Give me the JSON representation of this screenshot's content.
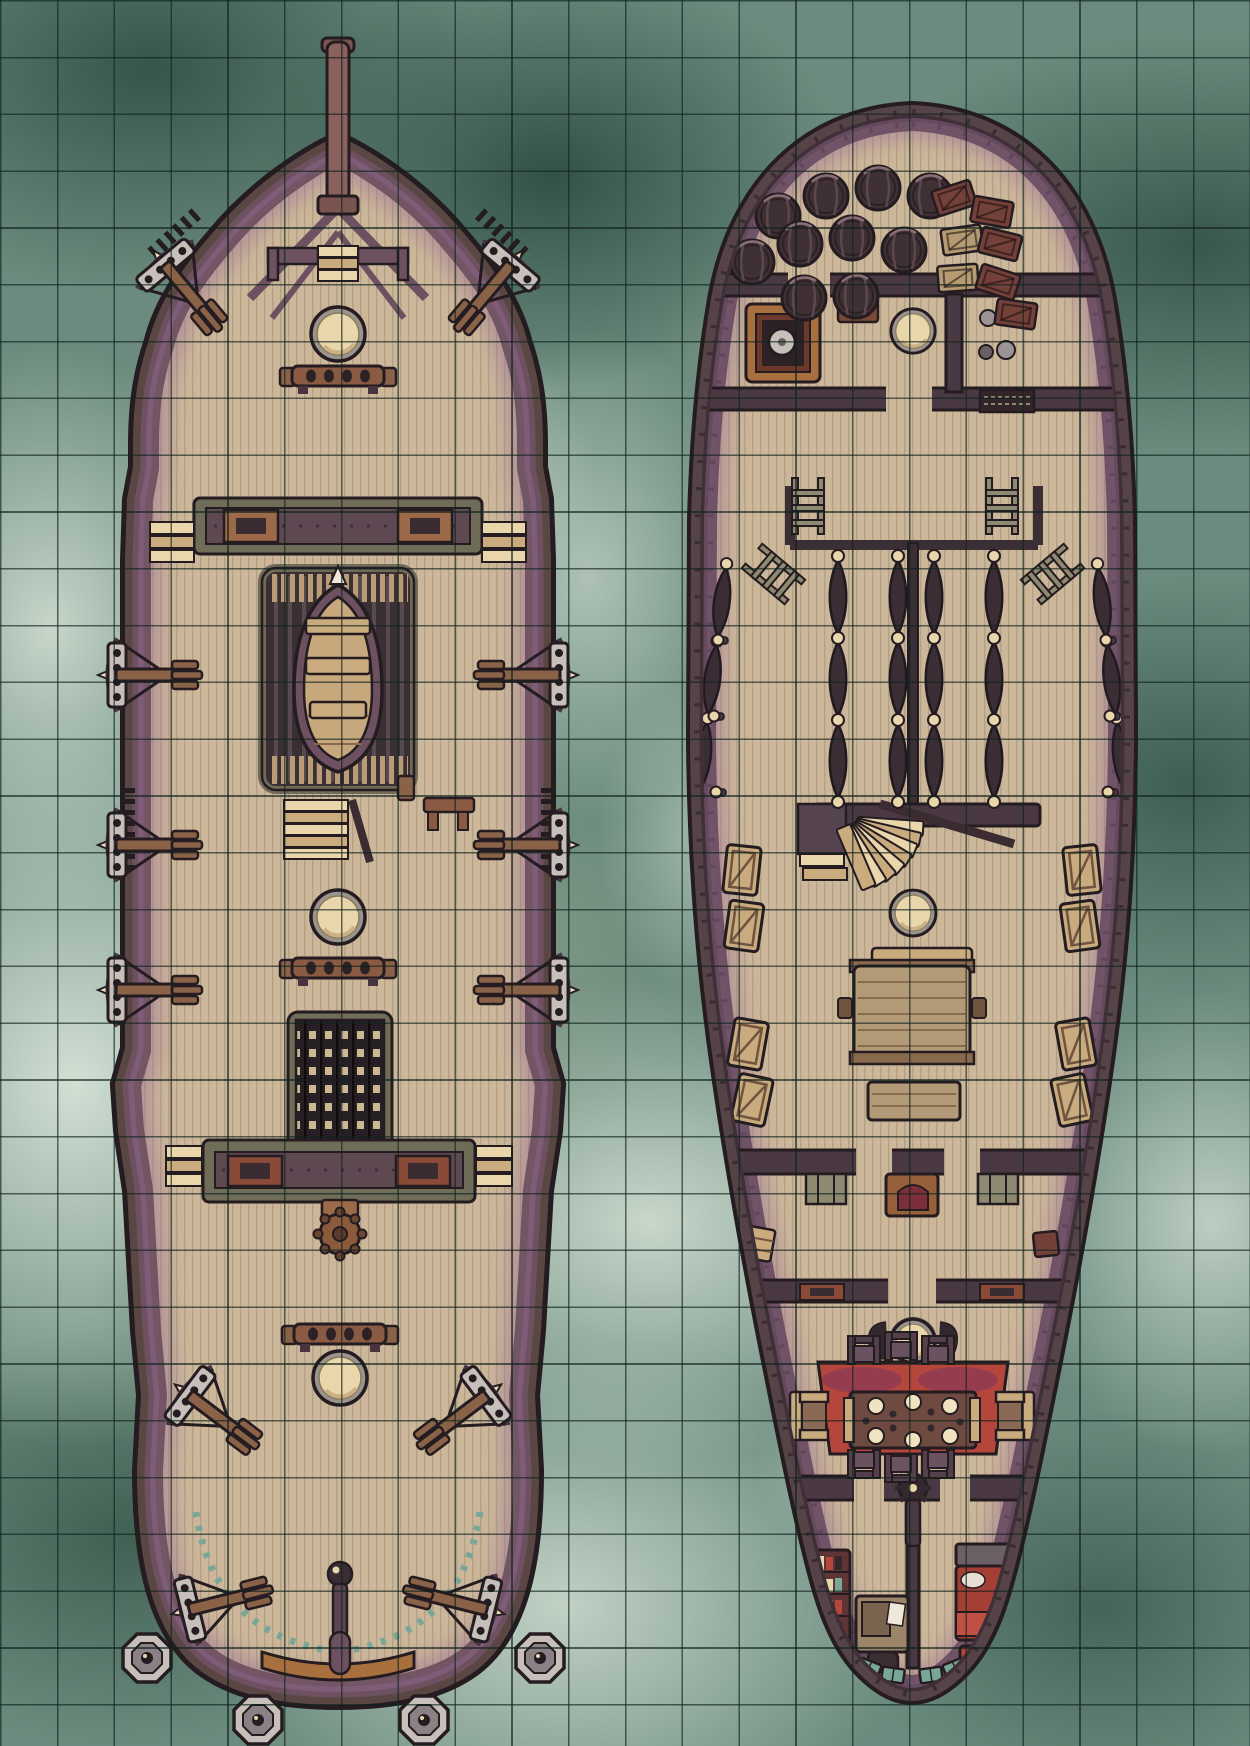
{
  "map": {
    "title": "Sailing ship battle map",
    "kind": "top-down tabletop battle map",
    "environment": "stormy green sea with white foam",
    "decks": [
      "weather deck (left ship view)",
      "lower deck interior (right ship view)"
    ]
  },
  "grid": {
    "cell_px": 56.8,
    "columns": 22,
    "rows": 31,
    "line_color": "rgba(16,34,29,0.65)"
  },
  "palette": {
    "sea-base": "#6a8b7d",
    "sea-dark": "#2e5449",
    "sea-foam": "#e6ede5",
    "sea-khaki": "#8e9a7f",
    "grid-line": "rgba(16,34,29,0.65)",
    "ink": "#241c20",
    "hull": "#5a4743",
    "hull2": "#564347",
    "deck": "#ccb79a",
    "deck-line": "#b5a084",
    "rail": "#6d5160",
    "rail-dark": "#473440",
    "olive": "#6f6c58",
    "olive-light": "#8e8a72",
    "wood-mid": "#8a6248",
    "wood-light": "#c9ab7e",
    "cream": "#ead6ab",
    "cream-bright": "#f2e3c0",
    "metal": "#c6bfba",
    "dark": "#32282e",
    "red": "#b5463c",
    "red-deep": "#8e3630",
    "orange": "#a9703f",
    "teal": "#79a797",
    "purple-shade": "rgba(148,104,146,0.45)"
  },
  "ships": [
    {
      "id": "weather-deck-ship",
      "label": "Weather deck (exterior top view)",
      "objects": [
        "bowsprit",
        "bow platform with stairs",
        "foremast",
        "mainmast",
        "mizzenmast",
        "belaying pin racks (3)",
        "harpoon ballistas (12)",
        "ship's boat on skid platform",
        "companionway stairs with bench",
        "cargo hatch grate",
        "forecastle bulkhead with brackets",
        "quarterdeck bulkhead with side steps",
        "ship's wheel",
        "tiller and rudder post",
        "stern lanterns (4)"
      ]
    },
    {
      "id": "lower-deck-ship",
      "label": "Lower deck (interior cutaway)",
      "objects": [
        "cargo barrels (10)",
        "supply crates (7)",
        "galley stove with kettle",
        "wall sconce",
        "round galley table",
        "pantry jugs",
        "companionway landing with ladders (4)",
        "crew hammock rows (6)",
        "fan staircase",
        "mess table with benches",
        "ammunition crates (8)",
        "wall shelves",
        "arched cabinet",
        "carved door panels",
        "captain's dining table",
        "dining chairs (6)",
        "armchairs (2)",
        "red carpet",
        "rudder gear",
        "bookshelf",
        "writing desk with chair",
        "captain's bed",
        "sea chest",
        "stern gallery windows (8)"
      ]
    }
  ],
  "placements": [
    {
      "target": "wd-ballistas",
      "symbol": "ballista",
      "items": [
        [
          188,
          292,
          50
        ],
        [
          488,
          292,
          130
        ],
        [
          152,
          675,
          0
        ],
        [
          152,
          845,
          0
        ],
        [
          152,
          990,
          0
        ],
        [
          524,
          675,
          180
        ],
        [
          524,
          845,
          180
        ],
        [
          524,
          990,
          180
        ],
        [
          218,
          1417,
          37
        ],
        [
          458,
          1417,
          143
        ],
        [
          224,
          1601,
          -14
        ],
        [
          452,
          1601,
          194
        ]
      ]
    },
    {
      "target": "wd-lanterns",
      "symbol": "lantern",
      "items": [
        [
          147,
          1658
        ],
        [
          258,
          1720
        ],
        [
          424,
          1720
        ],
        [
          540,
          1658
        ]
      ]
    },
    {
      "target": "wd-masts",
      "symbol": "mast",
      "items": [
        [
          338,
          334
        ],
        [
          338,
          917
        ],
        [
          340,
          1378
        ]
      ]
    },
    {
      "target": "wd-pinracks",
      "symbol": "pinrack",
      "items": [
        [
          338,
          376
        ],
        [
          338,
          968
        ],
        [
          340,
          1334
        ]
      ]
    },
    {
      "target": "ld-masts",
      "symbol": "mast",
      "items": [
        [
          913,
          331,
          0,
          0.82
        ],
        [
          913,
          913,
          0,
          0.85
        ],
        [
          913,
          1341,
          0,
          0.8
        ]
      ]
    },
    {
      "target": "ld-barrels",
      "symbol": "barrel",
      "items": [
        [
          778,
          216
        ],
        [
          826,
          196
        ],
        [
          878,
          188
        ],
        [
          930,
          196
        ],
        [
          752,
          262
        ],
        [
          800,
          244
        ],
        [
          852,
          238
        ],
        [
          904,
          250
        ],
        [
          804,
          298
        ],
        [
          856,
          296
        ]
      ]
    },
    {
      "target": "ld-bow-crates",
      "symbol": "crate",
      "items": [
        [
          954,
          198,
          -18,
          1,
          "c-red"
        ],
        [
          992,
          212,
          10,
          1,
          "c-red"
        ],
        [
          962,
          240,
          -8,
          1,
          "c-tan"
        ],
        [
          1000,
          244,
          14,
          1,
          "c-red"
        ],
        [
          958,
          278,
          -4,
          1,
          "c-tan"
        ],
        [
          998,
          282,
          18,
          1,
          "c-red"
        ],
        [
          1016,
          314,
          8,
          1,
          "c-red"
        ]
      ]
    },
    {
      "target": "ld-gun-crates",
      "symbol": "guncrate",
      "items": [
        [
          742,
          870,
          6
        ],
        [
          744,
          926,
          8
        ],
        [
          748,
          1044,
          10
        ],
        [
          752,
          1100,
          12
        ],
        [
          1082,
          870,
          -6
        ],
        [
          1080,
          926,
          -8
        ],
        [
          1076,
          1044,
          -10
        ],
        [
          1072,
          1100,
          -12
        ]
      ]
    },
    {
      "target": "ld-hammocks",
      "symbol": "hammocks",
      "items": [
        [
          838,
          552
        ],
        [
          898,
          552
        ],
        [
          934,
          552
        ],
        [
          994,
          552
        ],
        [
          727,
          560,
          7,
          0.95
        ],
        [
          1097,
          560,
          -7,
          0.95
        ]
      ]
    },
    {
      "target": "ld-chairs",
      "symbol": "chair",
      "items": [
        [
          864,
          1352
        ],
        [
          901,
          1348
        ],
        [
          938,
          1352
        ],
        [
          864,
          1462,
          180
        ],
        [
          901,
          1466,
          180
        ],
        [
          938,
          1462,
          180
        ]
      ]
    },
    {
      "target": "ld-windows",
      "symbol": "window",
      "items": [
        [
          822,
          1640,
          52
        ],
        [
          845,
          1656,
          38
        ],
        [
          869,
          1668,
          22
        ],
        [
          893,
          1675,
          8
        ],
        [
          1002,
          1640,
          -52
        ],
        [
          979,
          1656,
          -38
        ],
        [
          955,
          1668,
          -22
        ],
        [
          931,
          1675,
          -8
        ]
      ]
    },
    {
      "target": "ld-pegs",
      "symbol": "peg",
      "items": [
        [
          718,
          640
        ],
        [
          714,
          716
        ],
        [
          716,
          792
        ],
        [
          1106,
          640
        ],
        [
          1110,
          716
        ],
        [
          1108,
          792
        ]
      ]
    },
    {
      "target": "ld-ladders",
      "symbol": "ladder",
      "items": [
        [
          808,
          478
        ],
        [
          1002,
          478
        ],
        [
          752,
          556,
          -50
        ],
        [
          1074,
          556,
          50
        ]
      ]
    }
  ]
}
